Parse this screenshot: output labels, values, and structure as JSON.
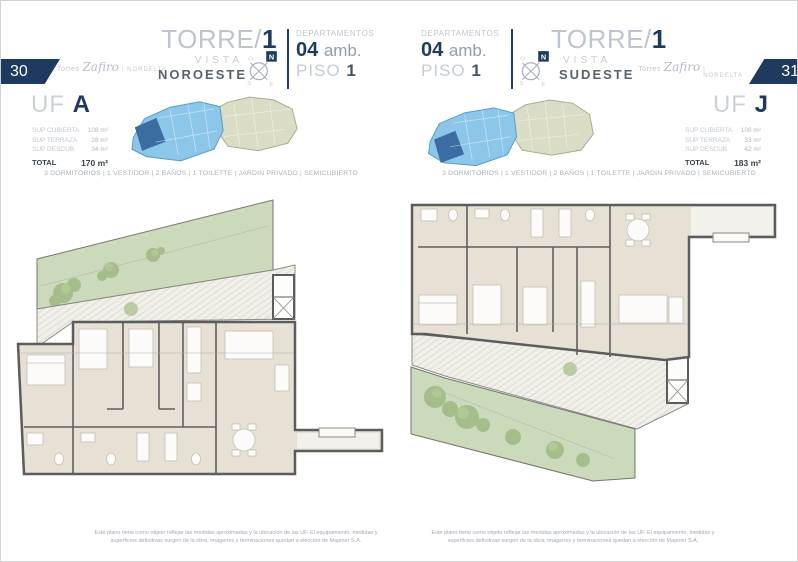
{
  "compass": {
    "n": "N",
    "s": "S",
    "e": "E",
    "o": "O"
  },
  "colors": {
    "navy": "#1e3a5f",
    "light_text": "#bfc6ce",
    "dark_text": "#4a545e",
    "plan_floor": "#e6e0d5",
    "wall": "#5c5c5c",
    "garden_green": "#cbdabb",
    "terrace_hatch": "#f1efe9",
    "keyplan_blue": "#8cc6e8",
    "keyplan_unit_blue": "#3b6da3",
    "keyplan_beige": "#dadcc6"
  },
  "left_page": {
    "page_number": "30",
    "brand": {
      "prefix": "Torres",
      "script": "Zafiro",
      "suffix": "| NORDELTA"
    },
    "tower_prefix": "TORRE/",
    "tower_number": "1",
    "vista_label": "VISTA",
    "vista_value": "NOROESTE",
    "dept_label": "DEPARTAMENTOS",
    "dept_number": "04",
    "dept_unit": "amb.",
    "piso_label": "PISO",
    "piso_number": "1",
    "uf_label": "UF",
    "uf_letter": "A",
    "surfaces": {
      "rows": [
        {
          "label": "SUP CUBIERTA",
          "value": "108 m²"
        },
        {
          "label": "SUP TERRAZA",
          "value": "28 m²"
        },
        {
          "label": "SUP DESCUB",
          "value": "34 m²"
        }
      ],
      "total_label": "TOTAL",
      "total_value": "170 m²"
    },
    "features": "3 DORMITORIOS | 1 VESTIDOR | 2 BAÑOS | 1 TOILETTE | JARDIN PRIVADO | SEMICUBIERTO",
    "disclaimer": "Este plano tiene como objeto reflejar las medidas aproximadas y la ubicación de las UF. El equipamiento, medidas y superficies definitivas surgen de la obra, imágenes y terminaciones quedan a elección de Mapiner S.A."
  },
  "right_page": {
    "page_number": "31",
    "brand": {
      "prefix": "Torres",
      "script": "Zafiro",
      "suffix": "| NORDELTA"
    },
    "tower_prefix": "TORRE/",
    "tower_number": "1",
    "vista_label": "VISTA",
    "vista_value": "SUDESTE",
    "dept_label": "DEPARTAMENTOS",
    "dept_number": "04",
    "dept_unit": "amb.",
    "piso_label": "PISO",
    "piso_number": "1",
    "uf_label": "UF",
    "uf_letter": "J",
    "surfaces": {
      "rows": [
        {
          "label": "SUP CUBIERTA",
          "value": "108 m²"
        },
        {
          "label": "SUP TERRAZA",
          "value": "33 m²"
        },
        {
          "label": "SUP DESCUB",
          "value": "42 m²"
        }
      ],
      "total_label": "TOTAL",
      "total_value": "183 m²"
    },
    "features": "3 DORMITORIOS | 1 VESTIDOR | 2 BAÑOS | 1 TOILETTE | JARDIN PRIVADO | SEMICUBIERTO",
    "disclaimer": "Este plano tiene como objeto reflejar las medidas aproximadas y la ubicación de las UF. El equipamiento, medidas y superficies definitivas surgen de la obra, imágenes y terminaciones quedan a elección de Mapiner S.A."
  }
}
